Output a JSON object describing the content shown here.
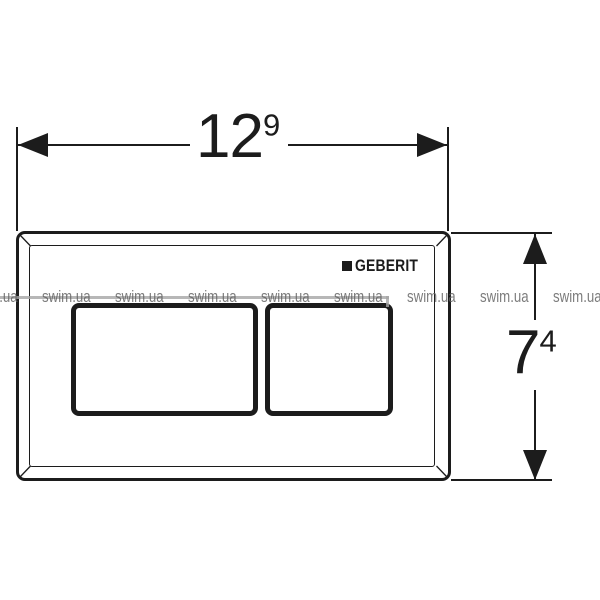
{
  "title": "Geberit flush plate dimension drawing",
  "brand": {
    "logo_text": "GEBERIT"
  },
  "dimensions": {
    "width_label": {
      "main": "12",
      "sup": "9"
    },
    "height_label": {
      "main": "7",
      "sup": "4"
    }
  },
  "watermark": {
    "text": "swim.ua",
    "positions_x": [
      -31,
      42,
      115,
      188,
      261,
      334,
      407,
      480,
      553
    ],
    "row_top_px": 288
  },
  "colors": {
    "ink": "#1c1c1c",
    "background": "#ffffff",
    "watermark_text": "rgba(95,95,95,0.82)",
    "watermark_line": "rgba(165,165,165,0.8)"
  }
}
